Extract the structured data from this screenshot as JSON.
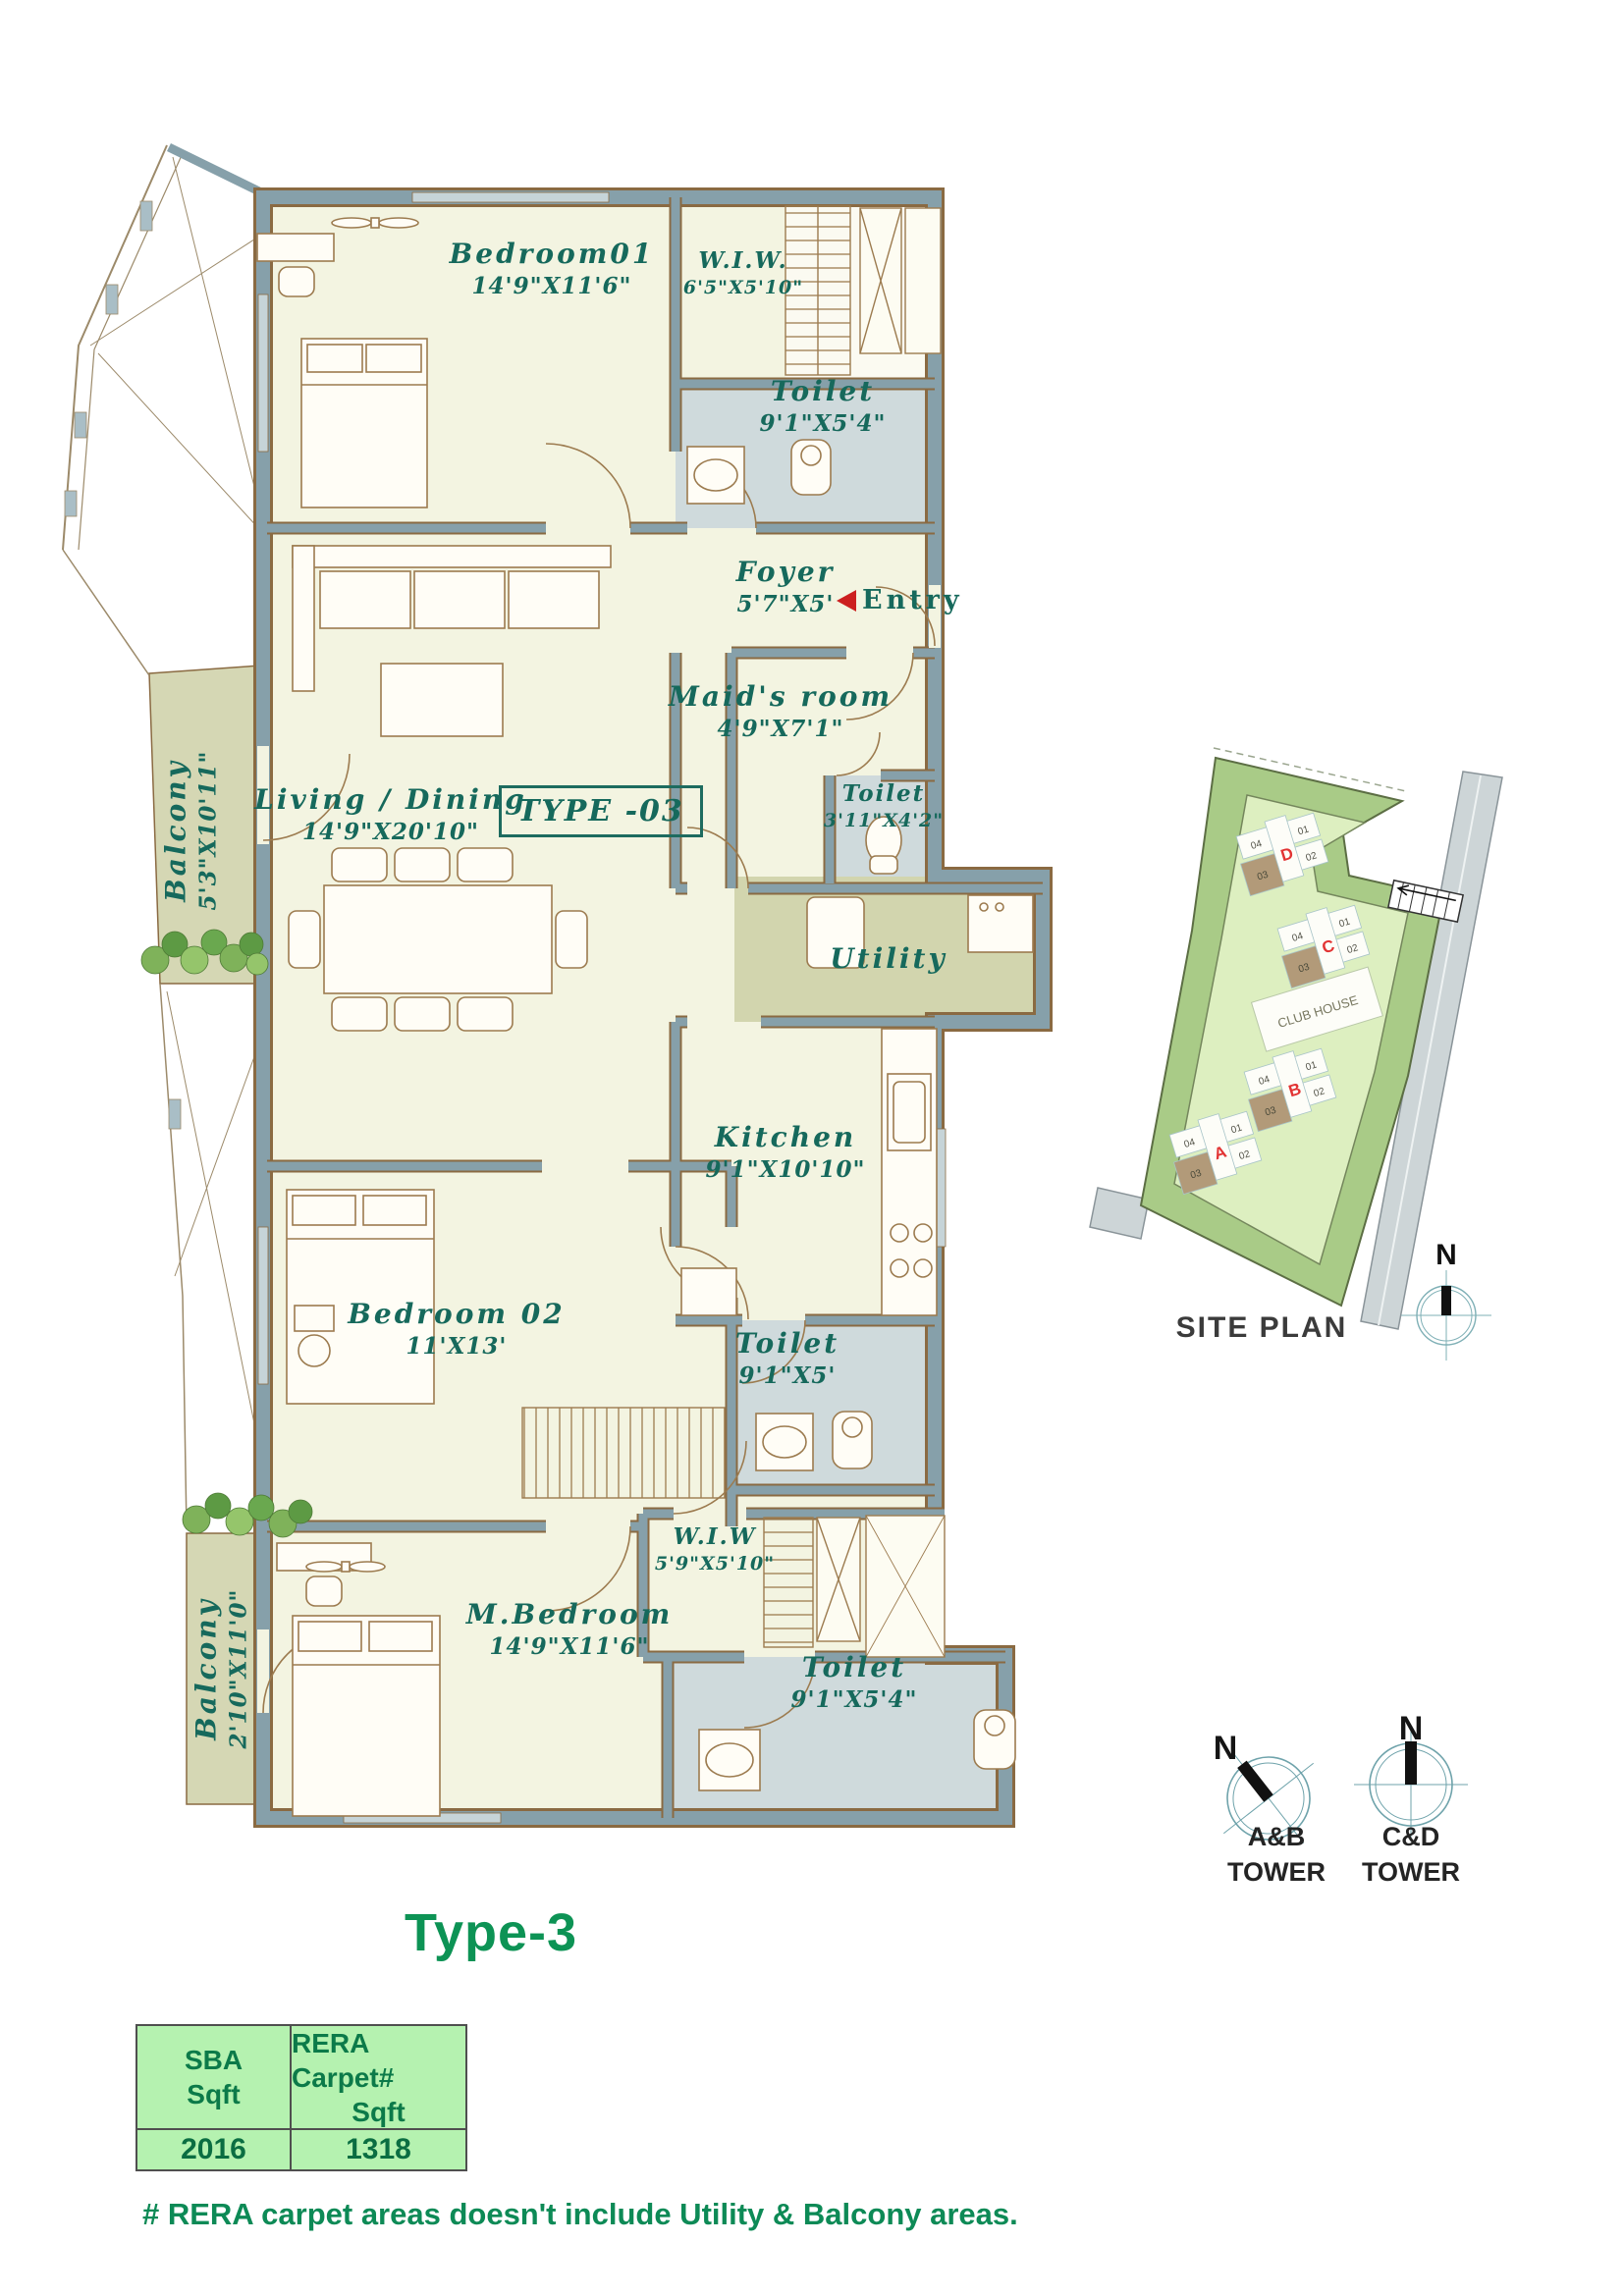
{
  "title": "Type-3",
  "floor_plan": {
    "type_badge": "TYPE -03",
    "entry_label": "Entry",
    "rooms": {
      "bedroom01": {
        "name": "Bedroom01",
        "dims": "14'9\"X11'6\""
      },
      "wiw1": {
        "name": "W.I.W.",
        "dims": "6'5\"X5'10\""
      },
      "toilet1": {
        "name": "Toilet",
        "dims": "9'1\"X5'4\""
      },
      "foyer": {
        "name": "Foyer",
        "dims": "5'7\"X5'"
      },
      "maids_room": {
        "name": "Maid's room",
        "dims": "4'9\"X7'1\""
      },
      "toilet2": {
        "name": "Toilet",
        "dims": "3'11\"X4'2\""
      },
      "living_dining": {
        "name": "Living / Dining",
        "dims": "14'9\"X20'10\""
      },
      "balcony1": {
        "name": "Balcony",
        "dims": "5'3\"X10'11\""
      },
      "utility": {
        "name": "Utility"
      },
      "kitchen": {
        "name": "Kitchen",
        "dims": "9'1\"X10'10\""
      },
      "bedroom02": {
        "name": "Bedroom 02",
        "dims": "11'X13'"
      },
      "toilet3": {
        "name": "Toilet",
        "dims": "9'1\"X5'"
      },
      "wiw2": {
        "name": "W.I.W",
        "dims": "5'9\"X5'10\""
      },
      "m_bedroom": {
        "name": "M.Bedroom",
        "dims": "14'9\"X11'6\""
      },
      "toilet4": {
        "name": "Toilet",
        "dims": "9'1\"X5'4\""
      },
      "balcony2": {
        "name": "Balcony",
        "dims": "2'10\"X11'0\""
      }
    }
  },
  "site_plan": {
    "label": "SITE PLAN",
    "club_house": "CLUB HOUSE",
    "north": "N",
    "towers": {
      "a": "A",
      "b": "B",
      "c": "C",
      "d": "D"
    },
    "units": {
      "u01": "01",
      "u02": "02",
      "u03": "03",
      "u04": "04"
    }
  },
  "compasses": {
    "ab": {
      "north": "N",
      "line1": "A&B",
      "line2": "TOWER"
    },
    "cd": {
      "north": "N",
      "line1": "C&D",
      "line2": "TOWER"
    }
  },
  "area_table": {
    "col1_header_l1": "SBA",
    "col1_header_l2": "Sqft",
    "col2_header_l1": "RERA Carpet#",
    "col2_header_l2": "Sqft",
    "col1_value": "2016",
    "col2_value": "1318"
  },
  "footnote": "# RERA carpet areas doesn't include Utility & Balcony areas.",
  "colors": {
    "wall": "#86a0aa",
    "floor": "#f3f4e1",
    "wet_area": "#cfdadc",
    "balcony": "#d5d7b4",
    "label_text": "#16695c",
    "accent_green": "#0d9355",
    "table_fill": "#b5f2b0",
    "entry_red": "#cc1f1f",
    "site_outer": "#a9cb87",
    "site_inner": "#ddefc0",
    "road": "#cdd5d7",
    "unit_highlight": "#b29a79",
    "tower_letter": "#e23333"
  }
}
